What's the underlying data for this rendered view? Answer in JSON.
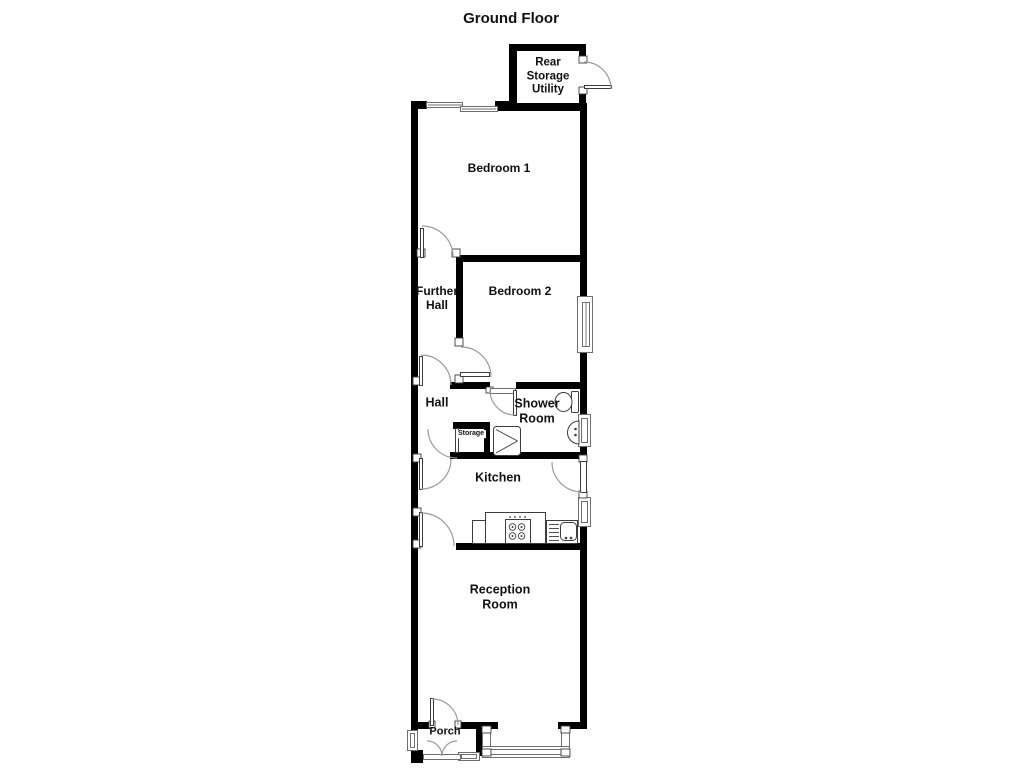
{
  "labels": {
    "title": "Ground Floor",
    "rear_storage_utility": "Rear\nStorage\nUtility",
    "bedroom_1": "Bedroom 1",
    "further_hall": "Further\nHall",
    "bedroom_2": "Bedroom 2",
    "hall": "Hall",
    "shower_room": "Shower\nRoom",
    "storage": "Storage",
    "kitchen": "Kitchen",
    "reception_room": "Reception\nRoom",
    "porch": "Porch"
  },
  "colors": {
    "wall": "#000000",
    "text": "#111111",
    "window_line": "#6e6e6e",
    "door_arc": "#9b9b9b",
    "fixture_line": "#3c3c3c",
    "background": "#ffffff"
  }
}
